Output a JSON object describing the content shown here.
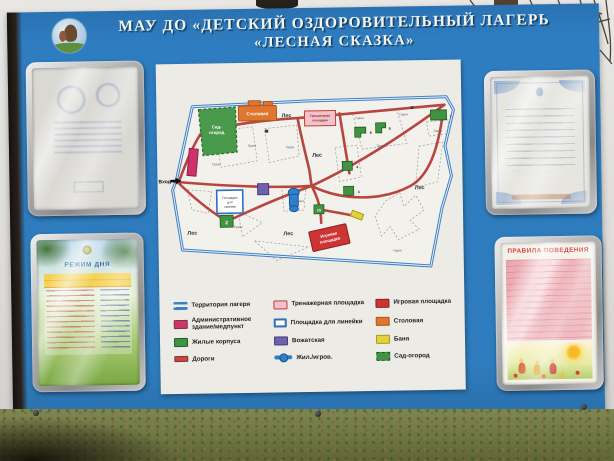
{
  "header": {
    "title_line1": "МАУ ДО «ДЕТСКИЙ ОЗДОРОВИТЕЛЬНЫЙ ЛАГЕРЬ",
    "title_line2": "«ЛЕСНАЯ СКАЗКА»"
  },
  "map": {
    "entrance_label": "Вход",
    "forest_label": "Лес",
    "lawn_label": "Газон",
    "garden_line1": "Сад-",
    "garden_line2": "огород",
    "canteen_label": "Столовая",
    "gym_line1": "Тренажерная",
    "gym_line2": "площадка",
    "assembly_line1": "Площадка",
    "assembly_line2": "для",
    "assembly_line3": "линейки",
    "playground_line1": "Игровая",
    "playground_line2": "площадка",
    "buildings": {
      "b2": "2",
      "b2a": "2А",
      "b3": "3",
      "b4": "4",
      "b8": "8",
      "b9": "9",
      "b7": "7"
    }
  },
  "legend": {
    "col1": [
      {
        "label": "Территория лагеря"
      },
      {
        "label": "Административное здание/медпункт"
      },
      {
        "label": "Жилые корпуса"
      },
      {
        "label": "Дороги"
      }
    ],
    "col2": [
      {
        "label": "Тренажерная площадка"
      },
      {
        "label": "Площадка для линейки"
      },
      {
        "label": "Вожатская"
      },
      {
        "label": "Жил./игров."
      }
    ],
    "col3": [
      {
        "label": "Игровая площадка"
      },
      {
        "label": "Столовая"
      },
      {
        "label": "Баня"
      },
      {
        "label": "Сад-огород"
      }
    ]
  },
  "posters": {
    "bottom_left_title": "РЕЖИМ ДНЯ",
    "bottom_right_title": "ПРАВИЛА ПОВЕДЕНИЯ"
  },
  "colors": {
    "board_blue": "#2e7cbd",
    "territory_outline": "#3f7fc4",
    "road_red": "#b8453f",
    "housing_green": "#3f9342",
    "admin_magenta": "#c9386b",
    "canteen_orange": "#e0762e",
    "gym_pink": "#f2c2cc",
    "counselor_purple": "#6f62ad",
    "playground_red": "#cc3533",
    "bathhouse_yellow": "#e3d23a",
    "water_blue": "#2f80cc"
  }
}
